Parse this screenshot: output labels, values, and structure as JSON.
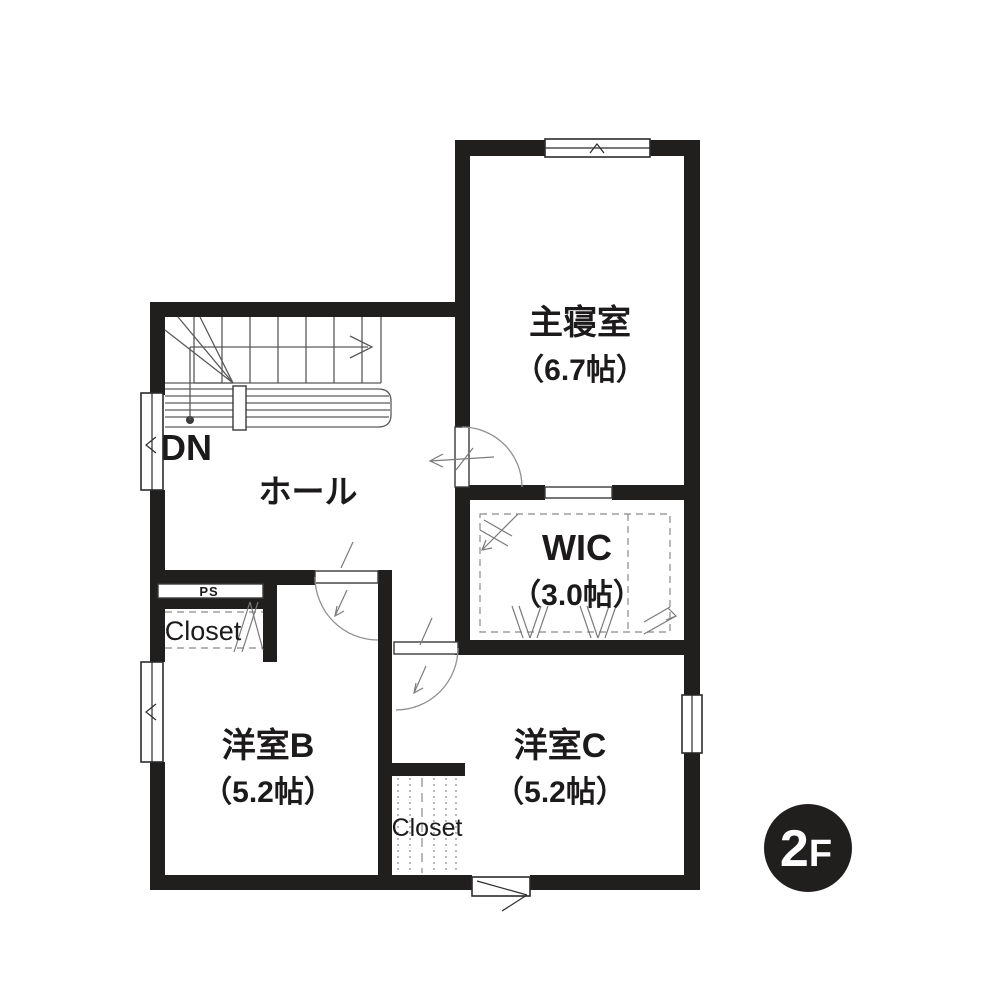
{
  "theme": {
    "bg": "#ffffff",
    "wall": "#211e1e",
    "line": "#5a5a5a",
    "lightline": "#8a8a8a",
    "text": "#1c1a1a",
    "badge_bg": "#211e1e",
    "badge_text": "#ffffff"
  },
  "floor_plan": {
    "floor_badge": {
      "label": "2F",
      "char_large": "2",
      "char_small": "F"
    },
    "stairs": {
      "direction_label": "DN"
    },
    "rooms": {
      "master_bedroom": {
        "name": "主寝室",
        "size": "（6.7帖）"
      },
      "hall": {
        "name": "ホール"
      },
      "wic": {
        "name": "WIC",
        "size": "（3.0帖）"
      },
      "western_room_b": {
        "name": "洋室B",
        "size": "（5.2帖）"
      },
      "western_room_c": {
        "name": "洋室C",
        "size": "（5.2帖）"
      },
      "closet_left": {
        "name": "Closet"
      },
      "closet_bottom": {
        "name": "Closet"
      },
      "pipe_space": {
        "name": "PS"
      }
    }
  }
}
